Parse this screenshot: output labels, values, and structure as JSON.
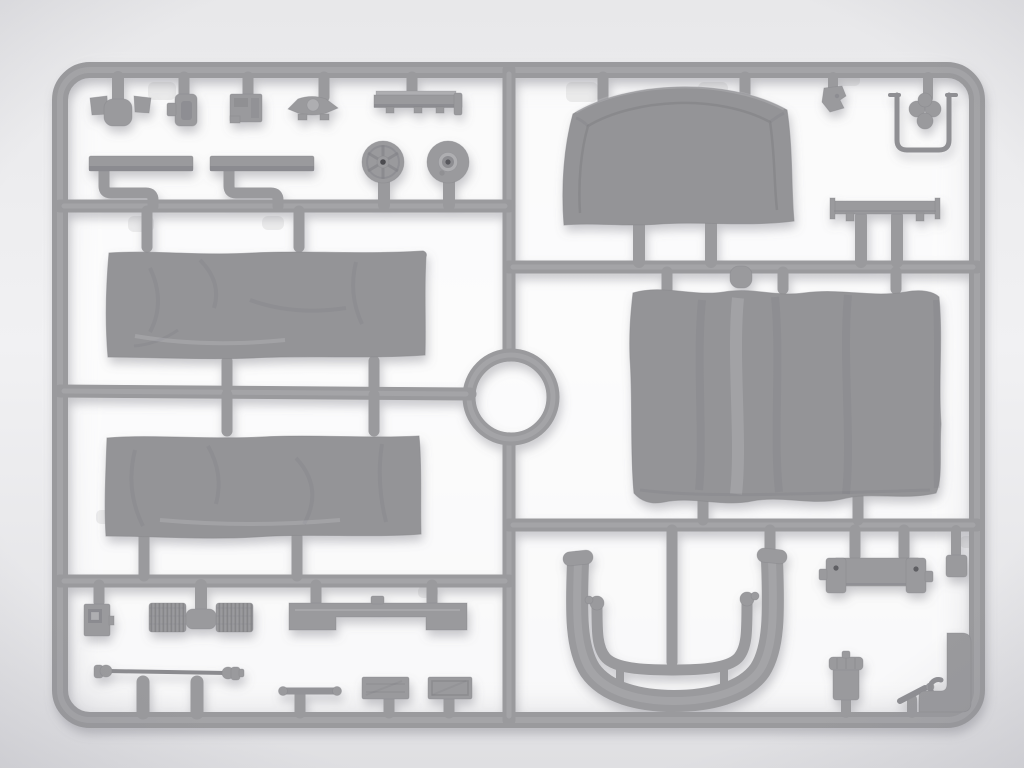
{
  "scene": {
    "description": "Overhead studio photograph of a light-grey injection-molded plastic model-kit sprue (runner frame) holding tarpaulin canvas panels, wheels, seats, chassis fittings and exhaust parts. No text is visible in the image.",
    "subject": "model kit sprue with parts",
    "visible_text": "none"
  },
  "colors": {
    "background_top": "#e8e8ea",
    "background_mid": "#f1f1f3",
    "background_bottom": "#dfdfe2",
    "bloom": "#ffffff",
    "plastic": "#9a9a9d",
    "plastic_hi": "#aeaeb1",
    "plastic_lo": "#85858a",
    "canvas": "#949497",
    "canvas_lo": "#8a8a8e",
    "detail_dark": "#6f6f74"
  },
  "sprue": {
    "frame": {
      "label": "rounded rectangular sprue outer frame"
    },
    "runners": {
      "vertical": "central vertical runner",
      "top_left": "upper-left horizontal runner",
      "mid_left": "middle-left horizontal runner",
      "bottom_left": "lower-left horizontal runner",
      "top_right": "upper-right horizontal runner",
      "bottom_right": "lower-right horizontal runner",
      "ring": "circular ring runner at sprue center"
    },
    "parts": {
      "pedestal": {
        "label": "pedestal fitting with two side pads"
      },
      "bracket_plate": {
        "label": "small vertical bracket plate"
      },
      "equipment_box": {
        "label": "small equipment box with panel detail"
      },
      "winged_fitting": {
        "label": "winged hub fitting with center boss"
      },
      "side_rail": {
        "label": "narrow mounting rail"
      },
      "running_board_left": {
        "label": "running board strip (left)"
      },
      "running_board_right": {
        "label": "running board strip (right)"
      },
      "spoked_wheel": {
        "label": "spoked wheel / pulley disc"
      },
      "hub_wheel": {
        "label": "wheel disc with raised hub"
      },
      "canvas_cab_panel": {
        "label": "arched canvas cab rear panel"
      },
      "small_clamp": {
        "label": "small irregular clamp fitting"
      },
      "handle_frame": {
        "label": "U-shaped handle frame with clover sprue blob"
      },
      "mount_rail": {
        "label": "flat mounting rail with end plates"
      },
      "canvas_side_upper": {
        "label": "rectangular wrinkled canvas side panel (upper)"
      },
      "canvas_side_lower": {
        "label": "rectangular wrinkled canvas side panel (lower)"
      },
      "canvas_roof": {
        "label": "large canvas roof panel with wavy edges"
      },
      "battery_box": {
        "label": "small box with recessed square panel"
      },
      "ribbed_cylinders": {
        "label": "pair of ribbed cylinders joined by sprue tee"
      },
      "bench_seat": {
        "label": "bench seat plank with center cutout"
      },
      "drive_shaft": {
        "label": "drive shaft with universal-joint ends"
      },
      "tie_rod": {
        "label": "short tie rod"
      },
      "tray_left": {
        "label": "low stowage tray (left)"
      },
      "tray_right": {
        "label": "low stowage tray (right)"
      },
      "mudguard": {
        "label": "deep U-shaped mudguard channel"
      },
      "exhaust_pipe": {
        "label": "U-shaped exhaust pipe with end knobs"
      },
      "engine_mount": {
        "label": "engine-mount bracket with end towers"
      },
      "spacer_block": {
        "label": "small square spacer block"
      },
      "canister": {
        "label": "canister with ribbed cap"
      },
      "fork_tool": {
        "label": "small fork / wrench fitting"
      },
      "corner_block": {
        "label": "molded block filling frame corner"
      }
    }
  }
}
